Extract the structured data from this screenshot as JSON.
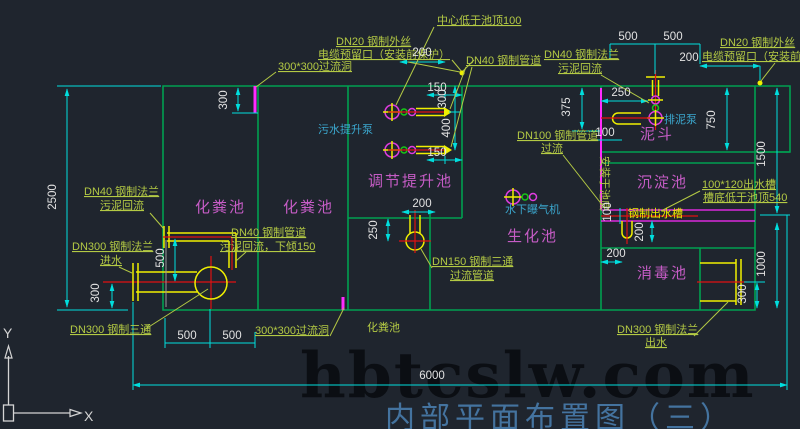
{
  "title": "内部平面布置图（三）",
  "watermark": "hbtcslw.com",
  "axis": {
    "x": "X",
    "y": "Y"
  },
  "pools": {
    "septic_a": "化粪池",
    "septic_b": "化粪池",
    "septic_c": "化粪池",
    "regulating": "调节提升池",
    "bio": "生化池",
    "sed": "沉淀池",
    "hopper": "泥斗",
    "disinfect": "消毒池"
  },
  "equipment": {
    "sewage_pump": "污水提升泵",
    "aerator": "水下曝气机",
    "mud_pump": "排泥泵",
    "steel_channel": "钢制出水槽"
  },
  "notes": {
    "center_low": "中心低于池顶100",
    "cable_l1": "DN20 钢制外丝",
    "cable_l2": "电缆预留口（安装前保护）",
    "hole_top": "300*300过流洞",
    "dn40_pipe": "DN40 钢制管道",
    "dn40_fl_mid1": "DN40 钢制法兰",
    "dn40_fl_mid2": "污泥回流",
    "cable_r1": "DN20 钢制外丝",
    "cable_r2": "电缆预留口（安装前保护）",
    "dn100_1": "DN100 钢制管道",
    "dn100_2": "过流",
    "bottom_note": "安装于池底",
    "dn40_fl_l1": "DN40 钢制法兰",
    "dn40_fl_l2": "污泥回流",
    "dn300_in1": "DN300 钢制法兰",
    "dn300_in2": "进水",
    "dn40_ret1": "DN40 钢制管道",
    "dn40_ret2": "污泥回流，下倾150",
    "dn300_tee": "DN300 钢制三通",
    "hole_bottom": "300*300过流洞",
    "dn150_1": "DN150 钢制三通",
    "dn150_2": "过流管道",
    "channel_1": "100*120出水槽",
    "channel_2": "槽底低于池顶540",
    "dn300_out1": "DN300 钢制法兰",
    "dn300_out2": "出水"
  },
  "dims": {
    "w2500": "2500",
    "tl300": "300",
    "top200": "200",
    "a150": "150",
    "a300": "300",
    "a400": "400",
    "b150": "150",
    "tee200": "200",
    "tee250": "250",
    "in500": "500",
    "in300": "300",
    "bl500a": "500",
    "bl500b": "500",
    "total6000": "6000",
    "tr500a": "500",
    "tr500b": "500",
    "tr200": "200",
    "r250": "250",
    "r375": "375",
    "r100": "100",
    "r750": "750",
    "r1500": "1500",
    "c100": "100",
    "c200v": "200",
    "dis200": "200",
    "out300": "300",
    "out1000": "1000"
  }
}
